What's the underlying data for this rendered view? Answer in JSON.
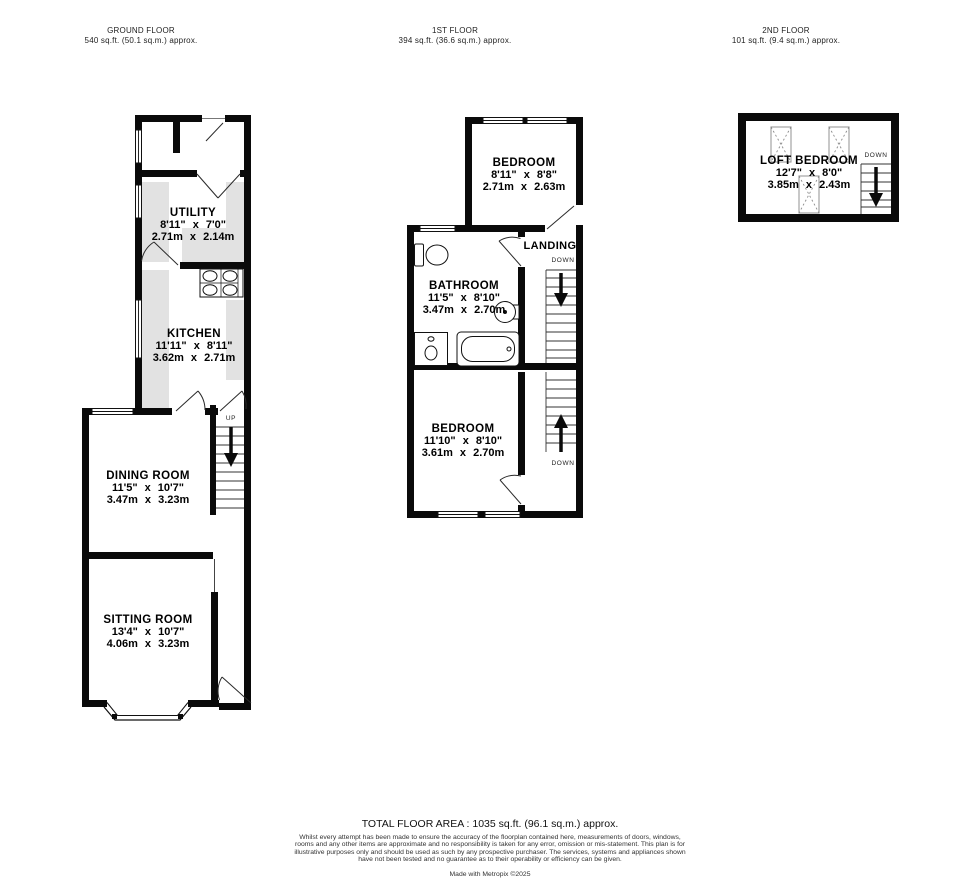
{
  "header_floors": [
    {
      "name": "GROUND FLOOR",
      "area": "540 sq.ft. (50.1 sq.m.) approx."
    },
    {
      "name": "1ST FLOOR",
      "area": "394 sq.ft. (36.6 sq.m.) approx."
    },
    {
      "name": "2ND FLOOR",
      "area": "101 sq.ft. (9.4 sq.m.) approx."
    }
  ],
  "ground": {
    "utility": {
      "name": "UTILITY",
      "imperial": "8'11\" x 7'0\"",
      "metric": "2.71m x 2.14m"
    },
    "kitchen": {
      "name": "KITCHEN",
      "imperial": "11'11\" x 8'11\"",
      "metric": "3.62m x 2.71m"
    },
    "dining": {
      "name": "DINING ROOM",
      "imperial": "11'5\" x 10'7\"",
      "metric": "3.47m x 3.23m"
    },
    "sitting": {
      "name": "SITTING ROOM",
      "imperial": "13'4\" x 10'7\"",
      "metric": "4.06m x 3.23m"
    },
    "stairs_up": "UP"
  },
  "first": {
    "bedroom1": {
      "name": "BEDROOM",
      "imperial": "8'11\" x 8'8\"",
      "metric": "2.71m x 2.63m"
    },
    "landing": {
      "name": "LANDING",
      "down": "DOWN"
    },
    "bathroom": {
      "name": "BATHROOM",
      "imperial": "11'5\" x 8'10\"",
      "metric": "3.47m x 2.70m"
    },
    "bedroom2": {
      "name": "BEDROOM",
      "imperial": "11'10\" x 8'10\"",
      "metric": "3.61m x 2.70m"
    },
    "stairs_down": "DOWN"
  },
  "second": {
    "loft": {
      "name": "LOFT BEDROOM",
      "imperial": "12'7\" x 8'0\"",
      "metric": "3.85m x 2.43m"
    },
    "stairs_down": "DOWN"
  },
  "footer": {
    "total": "TOTAL FLOOR AREA : 1035 sq.ft. (96.1 sq.m.) approx.",
    "disclaimer": "Whilst every attempt has been made to ensure the accuracy of the floorplan contained here, measurements of doors, windows, rooms and any other items are approximate and no responsibility is taken for any error, omission or mis-statement. This plan is for illustrative purposes only and should be used as such by any prospective purchaser. The services, systems and appliances shown have not been tested and no guarantee as to their operability or efficiency can be given.",
    "credit": "Made with Metropix ©2025"
  }
}
